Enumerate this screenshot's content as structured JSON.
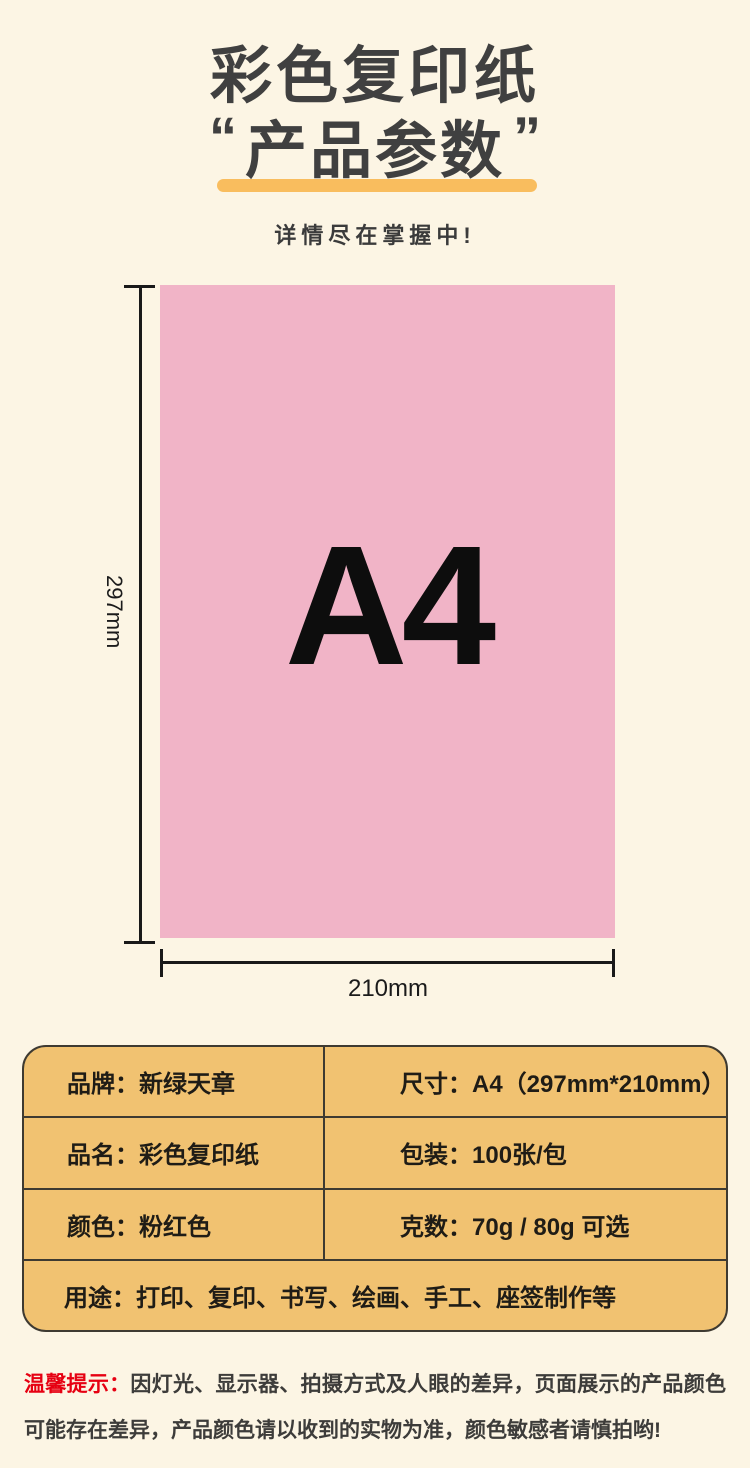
{
  "page": {
    "background": "#fcf5e4"
  },
  "header": {
    "title": "彩色复印纸",
    "quote_open": "“",
    "quote_close": "”",
    "subtitle": "产品参数",
    "tagline": "详情尽在掌握中!",
    "title_color": "#404040",
    "underline_color": "#f9bd5e"
  },
  "diagram": {
    "paper_label": "A4",
    "height_label": "297mm",
    "width_label": "210mm",
    "paper_color": "#f1b4c7",
    "line_color": "#191919"
  },
  "spec_table": {
    "background": "#f1c271",
    "border_color": "#3e3a31",
    "rows": [
      {
        "left": "品牌：新绿天章",
        "right": "尺寸：A4（297mm*210mm）"
      },
      {
        "left": "品名：彩色复印纸",
        "right": "包装：100张/包"
      },
      {
        "left": "颜色：粉红色",
        "right": "克数：70g / 80g 可选"
      },
      {
        "full": "用途：打印、复印、书写、绘画、手工、座签制作等"
      }
    ]
  },
  "notice": {
    "prefix": "温馨提示：",
    "prefix_color": "#e60012",
    "text": "因灯光、显示器、拍摄方式及人眼的差异，页面展示的产品颜色可能存在差异，产品颜色请以收到的实物为准，颜色敏感者请慎拍哟!"
  }
}
